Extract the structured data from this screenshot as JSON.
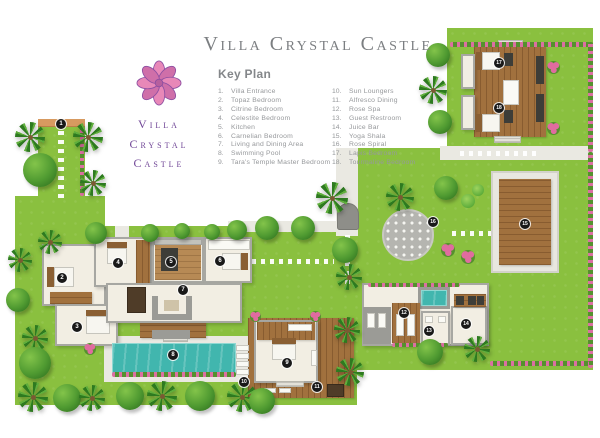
{
  "title": "Villa Crystal Castle",
  "logo": {
    "lines": [
      "Villa",
      "Crystal",
      "Castle"
    ]
  },
  "key_plan": {
    "heading": "Key Plan",
    "items": [
      {
        "num": 1,
        "label": "Villa Entrance"
      },
      {
        "num": 2,
        "label": "Topaz Bedroom"
      },
      {
        "num": 3,
        "label": "Citrine Bedroom"
      },
      {
        "num": 4,
        "label": "Celestite Bedroom"
      },
      {
        "num": 5,
        "label": "Kitchen"
      },
      {
        "num": 6,
        "label": "Carnelian Bedroom"
      },
      {
        "num": 7,
        "label": "Living and Dining Area"
      },
      {
        "num": 8,
        "label": "Swimming Pool"
      },
      {
        "num": 9,
        "label": "Tara's Temple Master Bedroom"
      },
      {
        "num": 10,
        "label": "Sun Loungers"
      },
      {
        "num": 11,
        "label": "Alfresco Dining"
      },
      {
        "num": 12,
        "label": "Rose Spa"
      },
      {
        "num": 13,
        "label": "Guest Restroom"
      },
      {
        "num": 14,
        "label": "Juice Bar"
      },
      {
        "num": 15,
        "label": "Yoga Shala"
      },
      {
        "num": 16,
        "label": "Rose Spiral"
      },
      {
        "num": 17,
        "label": "Lapis Bedroom"
      },
      {
        "num": 18,
        "label": "Tourmaline Bedroom"
      }
    ]
  },
  "map": {
    "markers": [
      {
        "num": 1,
        "x": 61,
        "y": 124
      },
      {
        "num": 2,
        "x": 62,
        "y": 278
      },
      {
        "num": 3,
        "x": 77,
        "y": 327
      },
      {
        "num": 4,
        "x": 118,
        "y": 263
      },
      {
        "num": 5,
        "x": 171,
        "y": 262
      },
      {
        "num": 6,
        "x": 220,
        "y": 261
      },
      {
        "num": 7,
        "x": 183,
        "y": 290
      },
      {
        "num": 8,
        "x": 173,
        "y": 355
      },
      {
        "num": 9,
        "x": 287,
        "y": 363
      },
      {
        "num": 10,
        "x": 244,
        "y": 382
      },
      {
        "num": 11,
        "x": 317,
        "y": 387
      },
      {
        "num": 12,
        "x": 404,
        "y": 313
      },
      {
        "num": 13,
        "x": 429,
        "y": 331
      },
      {
        "num": 14,
        "x": 466,
        "y": 324
      },
      {
        "num": 15,
        "x": 525,
        "y": 224
      },
      {
        "num": 16,
        "x": 433,
        "y": 222
      },
      {
        "num": 17,
        "x": 499,
        "y": 63
      },
      {
        "num": 18,
        "x": 499,
        "y": 108
      }
    ],
    "colors": {
      "lawn": "#8ac03f",
      "pool": "#41b6ae",
      "wood": "#a1713e",
      "path": "#eae9e2",
      "hedge_pink": "#dc6fa2",
      "logo_pink": "#e27db2",
      "logo_purple": "#6f4596",
      "title_gray": "#7b7e81",
      "badge": "#191919"
    }
  }
}
